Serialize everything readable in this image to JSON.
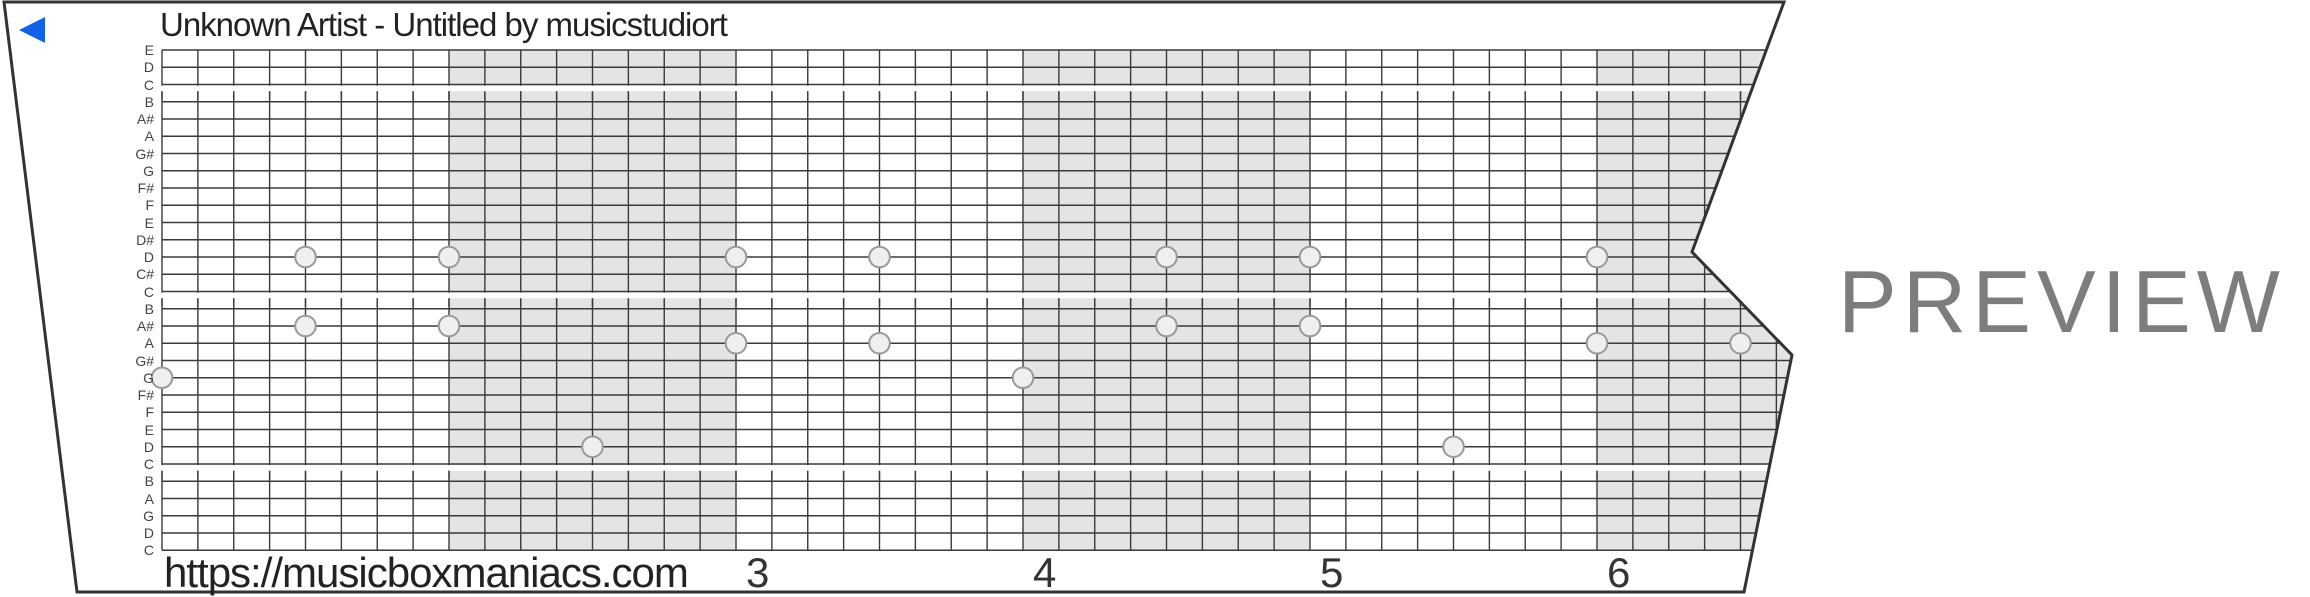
{
  "title": "Unknown Artist - Untitled by musicstudiort",
  "footer_url": "https://musicboxmaniacs.com",
  "watermark": "PREVIEW",
  "icons": {
    "direction_marker": "blue-left-triangle"
  },
  "colors": {
    "accent_blue": "#1063e6",
    "measure_shade": "#e4e4e4",
    "grid_line": "#3a3a3a",
    "paper_edge": "#333333",
    "note_fill": "#efefef",
    "note_stroke": "#999999",
    "watermark_gray": "#7d7d7d"
  },
  "strip": {
    "note_labels": [
      "E",
      "D",
      "C",
      "B",
      "A#",
      "A",
      "G#",
      "G",
      "F#",
      "F",
      "E",
      "D#",
      "D",
      "C#",
      "C",
      "B",
      "A#",
      "A",
      "G#",
      "G",
      "F#",
      "F",
      "E",
      "D",
      "C",
      "B",
      "A",
      "G",
      "D",
      "C"
    ],
    "octave_break_rows": [
      2,
      14,
      24
    ],
    "measures_total": 6,
    "cells_per_measure": 8,
    "shaded_measures": [
      2,
      4,
      6
    ],
    "measure_numbers": [
      {
        "measure": 3,
        "label": "3"
      },
      {
        "measure": 4,
        "label": "4"
      },
      {
        "measure": 5,
        "label": "5"
      },
      {
        "measure": 6,
        "label": "6"
      }
    ],
    "notes": [
      {
        "measure": 1,
        "cell": 0,
        "row": 19,
        "pitch": "G"
      },
      {
        "measure": 1,
        "cell": 4,
        "row": 12,
        "pitch": "D"
      },
      {
        "measure": 1,
        "cell": 4,
        "row": 16,
        "pitch": "A#"
      },
      {
        "measure": 2,
        "cell": 0,
        "row": 12,
        "pitch": "D"
      },
      {
        "measure": 2,
        "cell": 0,
        "row": 16,
        "pitch": "A#"
      },
      {
        "measure": 2,
        "cell": 4,
        "row": 23,
        "pitch": "D"
      },
      {
        "measure": 3,
        "cell": 0,
        "row": 12,
        "pitch": "D"
      },
      {
        "measure": 3,
        "cell": 0,
        "row": 17,
        "pitch": "A"
      },
      {
        "measure": 3,
        "cell": 4,
        "row": 12,
        "pitch": "D"
      },
      {
        "measure": 3,
        "cell": 4,
        "row": 17,
        "pitch": "A"
      },
      {
        "measure": 4,
        "cell": 0,
        "row": 19,
        "pitch": "G"
      },
      {
        "measure": 4,
        "cell": 4,
        "row": 12,
        "pitch": "D"
      },
      {
        "measure": 4,
        "cell": 4,
        "row": 16,
        "pitch": "A#"
      },
      {
        "measure": 5,
        "cell": 0,
        "row": 12,
        "pitch": "D"
      },
      {
        "measure": 5,
        "cell": 0,
        "row": 16,
        "pitch": "A#"
      },
      {
        "measure": 5,
        "cell": 4,
        "row": 23,
        "pitch": "D"
      },
      {
        "measure": 6,
        "cell": 0,
        "row": 12,
        "pitch": "D"
      },
      {
        "measure": 6,
        "cell": 0,
        "row": 17,
        "pitch": "A"
      },
      {
        "measure": 6,
        "cell": 4,
        "row": 17,
        "pitch": "A"
      }
    ]
  }
}
